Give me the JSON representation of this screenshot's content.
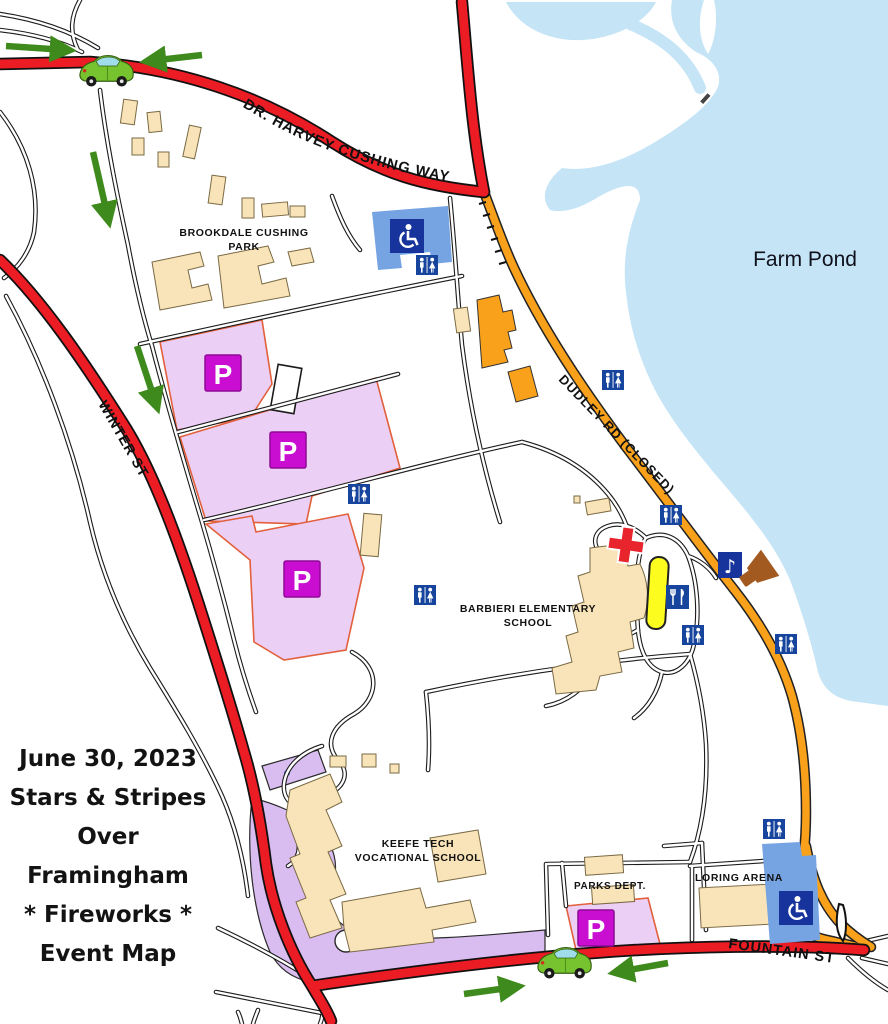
{
  "map": {
    "title": {
      "lines": [
        "June 30, 2023",
        "Stars & Stripes",
        "Over",
        "Framingham",
        "* Fireworks *",
        "Event Map"
      ]
    },
    "roads": {
      "dr_harvey_cushing_way": "DR. HARVEY CUSHING WAY",
      "winter_st": "WINTER ST",
      "dudley_rd_closed": "DUDLEY RD (CLOSED)",
      "fountain_st": "FOUNTAIN ST"
    },
    "places": {
      "farm_pond": "Farm Pond",
      "brookdale_line1": "BROOKDALE CUSHING",
      "brookdale_line2": "PARK",
      "barbieri_line1": "BARBIERI ELEMENTARY",
      "barbieri_line2": "SCHOOL",
      "keefe_line1": "KEEFE TECH",
      "keefe_line2": "VOCATIONAL SCHOOL",
      "parks_dept": "PARKS DEPT.",
      "loring_arena": "LORING ARENA"
    },
    "markers": {
      "parking_letter": "P",
      "music_glyph": "♪"
    },
    "icons": [
      "parking-icon",
      "restroom-icon",
      "handicap-parking-icon",
      "food-icon",
      "music-icon",
      "speaker-icon",
      "first-aid-icon",
      "car-icon",
      "direction-arrow-icon"
    ],
    "colors": {
      "water": "#C5E5F7",
      "road_red": "#EC1C24",
      "road_closed_orange": "#F9A11B",
      "parking_fill": "#ECCFF4",
      "parking_border": "#E2603C",
      "parking_badge": "#C90ED1",
      "event_area_lavender": "#D9BCF0",
      "building_tan": "#F8E4B8",
      "icon_blue": "#17459E",
      "handicap_square_blue": "#17349C",
      "handicap_area_blue": "#76A4E2",
      "arrow_green": "#3E8A1C",
      "stage_yellow": "#FCFC1E",
      "first_aid_red": "#E8242C",
      "speaker_brown": "#A35A21"
    }
  }
}
